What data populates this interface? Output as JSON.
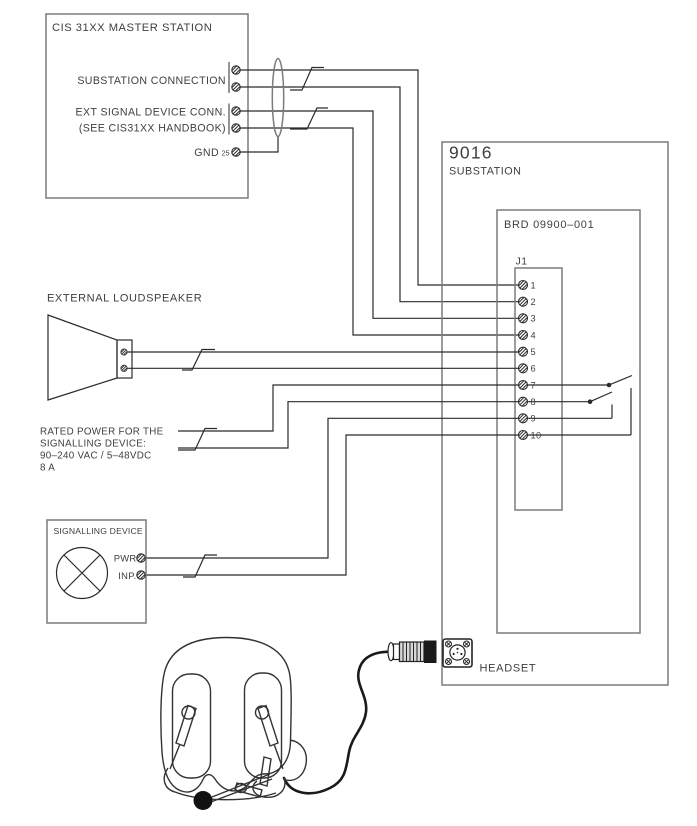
{
  "diagram": {
    "master_station": {
      "title": "CIS 31XX MASTER STATION",
      "port_substation": "SUBSTATION CONNECTION",
      "port_ext_signal_1": "EXT SIGNAL DEVICE CONN.",
      "port_ext_signal_2": "(SEE CIS31XX HANDBOOK)",
      "port_gnd": "GND",
      "gnd_pin_no": "25"
    },
    "substation": {
      "model": "9016",
      "name": "SUBSTATION",
      "board": "BRD 09900–001",
      "connector": "J1",
      "pins": [
        "1",
        "2",
        "3",
        "4",
        "5",
        "6",
        "7",
        "8",
        "9",
        "10"
      ],
      "headset_port": "HEADSET"
    },
    "loudspeaker": {
      "title": "EXTERNAL LOUDSPEAKER"
    },
    "power_note": {
      "l1": "RATED POWER FOR THE",
      "l2": "SIGNALLING DEVICE:",
      "l3": "90–240 VAC / 5–48VDC",
      "l4": "8 A"
    },
    "signalling_device": {
      "title": "SIGNALLING DEVICE",
      "pwr": "PWR",
      "inp": "INP."
    }
  },
  "colors": {
    "wire": "#2b2b2b",
    "box": "#7b7b7b",
    "text": "#3f3f3f",
    "ink": "#1a1a1a"
  }
}
